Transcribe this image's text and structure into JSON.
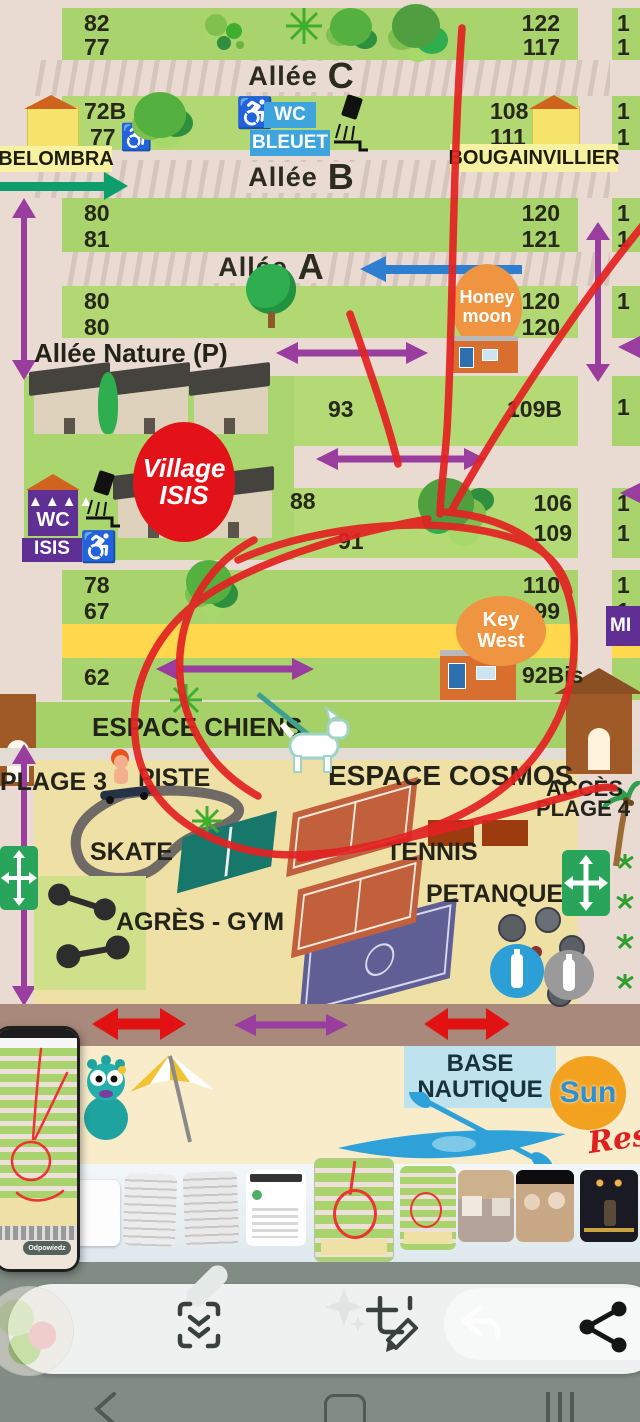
{
  "map": {
    "row1": {
      "l1": "82",
      "l2": "77",
      "r1": "122",
      "r2": "117"
    },
    "alley_c": {
      "word": "Allée",
      "letter": "C"
    },
    "row2": {
      "l1": "72B",
      "l2": "77",
      "r1": "108",
      "r2": "111"
    },
    "wc_bleuet": {
      "top": "WC",
      "bottom": "BLEUET"
    },
    "sector_left": "BELOMBRA",
    "sector_right": "BOUGAINVILLIER",
    "alley_b": {
      "word": "Allée",
      "letter": "B"
    },
    "row3": {
      "l1": "80",
      "l2": "81",
      "r1": "120",
      "r2": "121"
    },
    "alley_a": {
      "word": "Allée",
      "letter": "A"
    },
    "row4": {
      "l1": "80",
      "l2": "80",
      "r1": "120",
      "r2": "120"
    },
    "honeymoon": {
      "top": "Honey",
      "bottom": "moon"
    },
    "alley_nature": "Allée Nature (P)",
    "village_isis": {
      "top": "Village",
      "bottom": "ISIS"
    },
    "wc_isis": {
      "top": "WC",
      "bottom": "ISIS"
    },
    "n93": "93",
    "n109b": "109B",
    "n88": "88",
    "n91": "91",
    "n106": "106",
    "n109": "109",
    "row5": {
      "l1": "78",
      "l2": "67",
      "r1": "110",
      "r2": "99"
    },
    "keywest": {
      "top": "Key",
      "bottom": "West"
    },
    "n62": "62",
    "n92bis": "92Bis",
    "mimosa_partial": "MI",
    "espace_chiens": "ESPACE CHIENS",
    "plage3": "PLAGE 3",
    "piste": "PISTE",
    "skate": "SKATE",
    "espace_cosmos": "ESPACE COSMOS",
    "acces": "ACCÈS",
    "plage4": "PLAGE 4",
    "tennis": "TENNIS",
    "petanque": "PETANQUE",
    "agres_gym": "AGRÈS - GYM",
    "edge_digit": "1"
  },
  "beach": {
    "base_line1": "BASE",
    "base_line2": "NAUTIQUE",
    "sun_logo": "Sun",
    "res_script": "Res"
  },
  "phone_preview": {
    "reply_button": "Odpowiedz"
  },
  "toolbar": {
    "reply_ghost_label": "Odpowie"
  },
  "icons": {
    "wheelchair": "♿"
  },
  "colors": {
    "annotation_red": "#e32222",
    "accent_purple": "#993d9e",
    "wc_blue": "#3da4de",
    "isis_purple": "#5f2f93",
    "poi_orange": "#ef9440",
    "village_red": "#e31219"
  }
}
